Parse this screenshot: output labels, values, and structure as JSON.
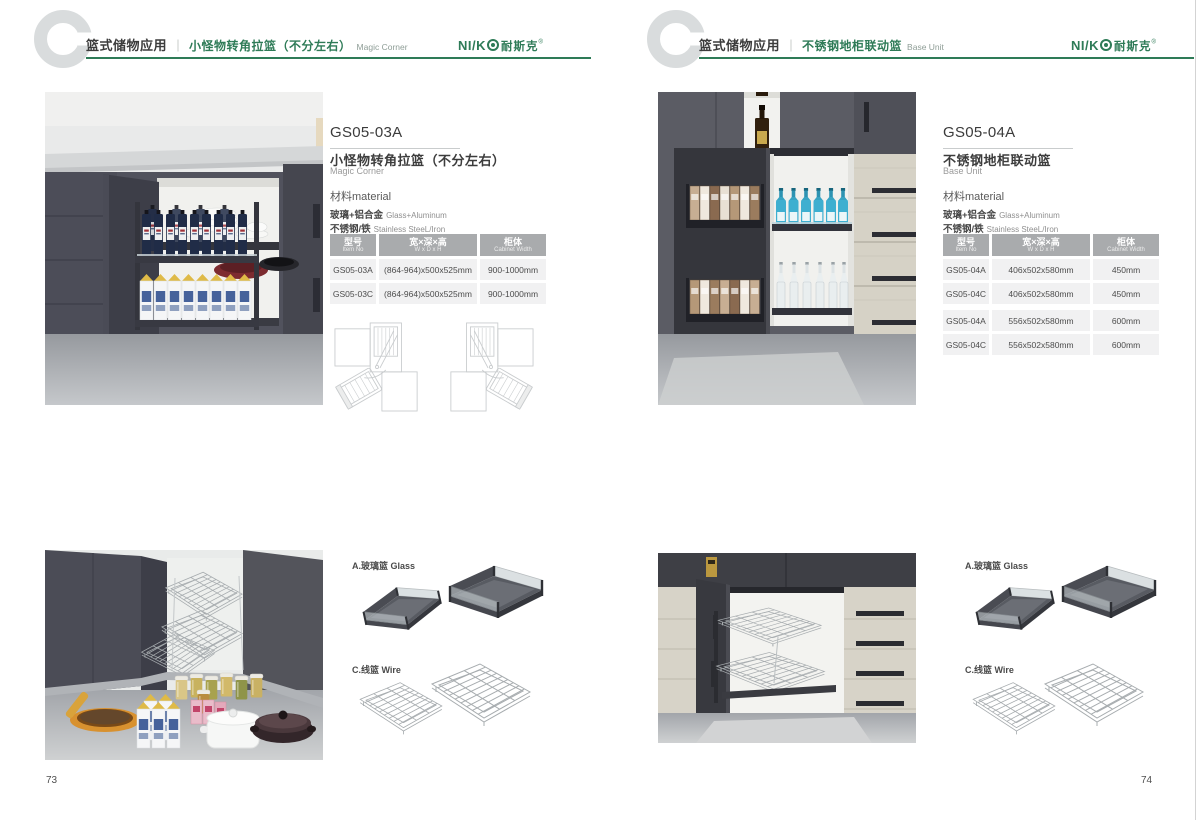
{
  "brand": {
    "latin": "NI/K",
    "cn": "耐斯克",
    "reg": "®",
    "green": "#2e7b57"
  },
  "shared": {
    "category": "篮式储物应用",
    "divider": "｜",
    "material_label": "材料material",
    "materials": [
      {
        "cn": "玻璃+铝合金",
        "en": "Glass+Aluminum"
      },
      {
        "cn": "不锈钢/铁",
        "en": "Stainless SteeL/Iron"
      }
    ],
    "table_headers": [
      {
        "cn": "型号",
        "en": "Item No"
      },
      {
        "cn": "宽×深×高",
        "en": "W x D x H"
      },
      {
        "cn": "柜体",
        "en": "Cabinet Width"
      }
    ],
    "accessory_glass_label": "A.玻璃篮 Glass",
    "accessory_wire_label": "C.线篮 Wire"
  },
  "pages": [
    {
      "page_number": "73",
      "header": {
        "title_cn": "小怪物转角拉篮（不分左右）",
        "title_en": "Magic Corner"
      },
      "product": {
        "model": "GS05-03A",
        "name_cn": "小怪物转角拉篮（不分左右）",
        "name_en": "Magic Corner"
      },
      "rows": [
        [
          "GS05-03A",
          "(864-964)x500x525mm",
          "900-1000mm"
        ],
        [
          "GS05-03C",
          "(864-964)x500x525mm",
          "900-1000mm"
        ]
      ]
    },
    {
      "page_number": "74",
      "header": {
        "title_cn": "不锈钢地柜联动篮",
        "title_en": "Base Unit"
      },
      "product": {
        "model": "GS05-04A",
        "name_cn": "不锈钢地柜联动篮",
        "name_en": "Base Unit"
      },
      "rows": [
        [
          "GS05-04A",
          "406x502x580mm",
          "450mm"
        ],
        [
          "GS05-04C",
          "406x502x580mm",
          "450mm"
        ],
        [
          "GS05-04A",
          "556x502x580mm",
          "600mm"
        ],
        [
          "GS05-04C",
          "556x502x580mm",
          "600mm"
        ]
      ]
    }
  ]
}
